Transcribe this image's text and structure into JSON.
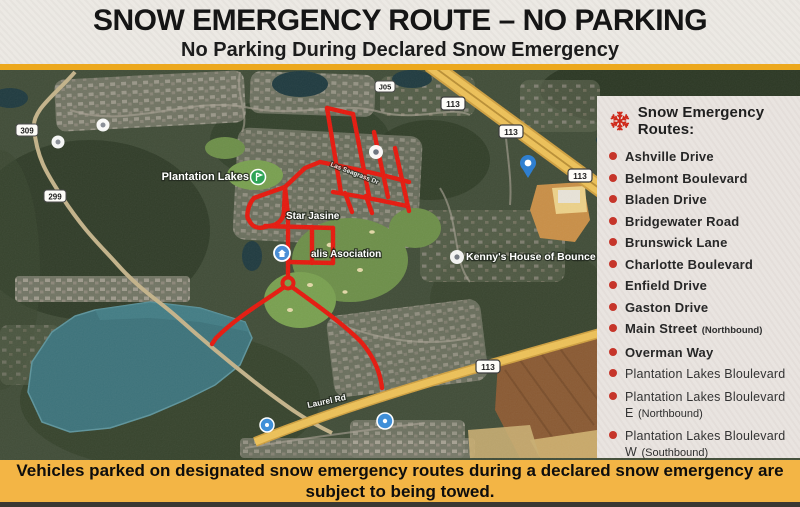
{
  "header": {
    "title": "SNOW EMERGENCY ROUTE – NO PARKING",
    "subtitle": "No Parking During Declared Snow Emergency"
  },
  "map": {
    "labels": {
      "plantation_lakes": "Plantation Lakes",
      "star_jasine": "Star Jasine",
      "association": "alis Asociation",
      "kennys": "Kenny's House of Bounce",
      "laurel_rd": "Laurel Rd",
      "seagrass_dr": "Las Seagrass Dr"
    },
    "shields": {
      "route_309": "309",
      "route_299": "299",
      "route_j05": "J05",
      "route_113": "113"
    }
  },
  "sidebar": {
    "icon": "snowflake",
    "title": "Snow Emergency Routes:",
    "items": [
      {
        "label": "Ashville Drive",
        "note": "",
        "emphasis": true
      },
      {
        "label": "Belmont Boulevard",
        "note": "",
        "emphasis": true
      },
      {
        "label": "Bladen Drive",
        "note": "",
        "emphasis": true
      },
      {
        "label": "Bridgewater Road",
        "note": "",
        "emphasis": true
      },
      {
        "label": "Brunswick Lane",
        "note": "",
        "emphasis": true
      },
      {
        "label": "Charlotte Boulevard",
        "note": "",
        "emphasis": true
      },
      {
        "label": "Enfield Drive",
        "note": "",
        "emphasis": true
      },
      {
        "label": "Gaston Drive",
        "note": "",
        "emphasis": true
      },
      {
        "label": "Main Street",
        "note": "(Northbound)",
        "emphasis": true
      },
      {
        "label": "Overman Way",
        "note": "",
        "emphasis": true
      },
      {
        "label": "Plantation Lakes Bloulevard",
        "note": "",
        "emphasis": false
      },
      {
        "label": "Plantation Lakes Bloulevard E",
        "note": "(Northbound)",
        "emphasis": false
      },
      {
        "label": "Plantation Lakes Bloulevard W",
        "note": "(Southbound)",
        "emphasis": false
      },
      {
        "label": "Washington Street",
        "note": "(Southbound)",
        "emphasis": true
      },
      {
        "label": "Whitaker Way",
        "note": "",
        "emphasis": true
      }
    ]
  },
  "footer": {
    "text": "Vehicles parked on designated snow emergency routes during a declared snow emergency are subject to being towed."
  },
  "colors": {
    "accent_red": "#cf2a1b",
    "route_red": "#e6190e",
    "banner_orange": "#f3b545",
    "divider_gold": "#eca81d",
    "highway_yellow": "#edc158",
    "lake_teal": "#3d737b"
  }
}
